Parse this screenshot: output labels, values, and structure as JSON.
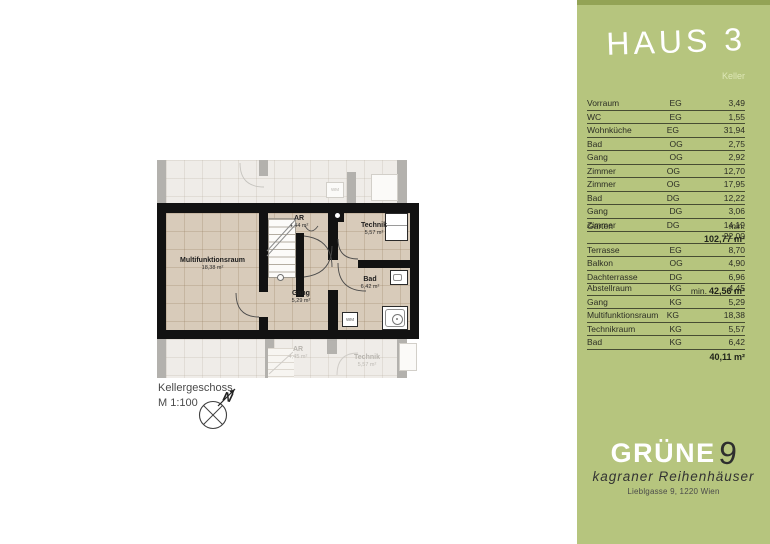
{
  "colors": {
    "panel_green": "#b6c57e",
    "panel_green_dark": "#93a355",
    "wall_black": "#121212",
    "floor_tan": "#d8cbba",
    "faded_gray": "#b3b1ad"
  },
  "panel": {
    "title": "HAUS 3",
    "subtitle": "Keller",
    "rooms_table": {
      "rows": [
        {
          "name": "Vorraum",
          "floor": "EG",
          "area": "3,49"
        },
        {
          "name": "WC",
          "floor": "EG",
          "area": "1,55"
        },
        {
          "name": "Wohnküche",
          "floor": "EG",
          "area": "31,94"
        },
        {
          "name": "Bad",
          "floor": "OG",
          "area": "2,75"
        },
        {
          "name": "Gang",
          "floor": "OG",
          "area": "2,92"
        },
        {
          "name": "Zimmer",
          "floor": "OG",
          "area": "12,70"
        },
        {
          "name": "Zimmer",
          "floor": "OG",
          "area": "17,95"
        },
        {
          "name": "Bad",
          "floor": "DG",
          "area": "12,22"
        },
        {
          "name": "Gang",
          "floor": "DG",
          "area": "3,06"
        },
        {
          "name": "Zimmer",
          "floor": "DG",
          "area": "14,19"
        }
      ],
      "total": "102,77 m²"
    },
    "outdoor_table": {
      "rows": [
        {
          "name": "Garten",
          "floor": "",
          "area": "min. 22,00"
        },
        {
          "name": "Terrasse",
          "floor": "EG",
          "area": "8,70"
        },
        {
          "name": "Balkon",
          "floor": "OG",
          "area": "4,90"
        },
        {
          "name": "Dachterrasse",
          "floor": "DG",
          "area": "6,96"
        }
      ],
      "total_prefix": "min.",
      "total": "42,56 m²"
    },
    "basement_table": {
      "rows": [
        {
          "name": "Abstellraum",
          "floor": "KG",
          "area": "4,45"
        },
        {
          "name": "Gang",
          "floor": "KG",
          "area": "5,29"
        },
        {
          "name": "Multifunktionsraum",
          "floor": "KG",
          "area": "18,38"
        },
        {
          "name": "Technikraum",
          "floor": "KG",
          "area": "5,57"
        },
        {
          "name": "Bad",
          "floor": "KG",
          "area": "6,42"
        }
      ],
      "total": "40,11 m²"
    },
    "logo": {
      "brand": "GRÜNE",
      "brand_number": "9",
      "tagline": "kagraner Reihenhäuser",
      "address": "Lieblgasse 9, 1220 Wien"
    }
  },
  "plan": {
    "caption_title": "Kellergeschoss",
    "caption_scale": "M 1:100",
    "north_label": "N",
    "wm_label": "WM",
    "rooms": [
      {
        "name": "Multifunktionsraum",
        "area": "18,38 m²"
      },
      {
        "name": "AR",
        "area": "4,44 m²"
      },
      {
        "name": "Technik",
        "area": "5,57 m²"
      },
      {
        "name": "Gang",
        "area": "5,29 m²"
      },
      {
        "name": "Bad",
        "area": "6,42 m²"
      }
    ],
    "faded_rooms": [
      {
        "name": "AR",
        "area": "4,45 m²"
      },
      {
        "name": "Technik",
        "area": "5,57 m²"
      }
    ]
  }
}
